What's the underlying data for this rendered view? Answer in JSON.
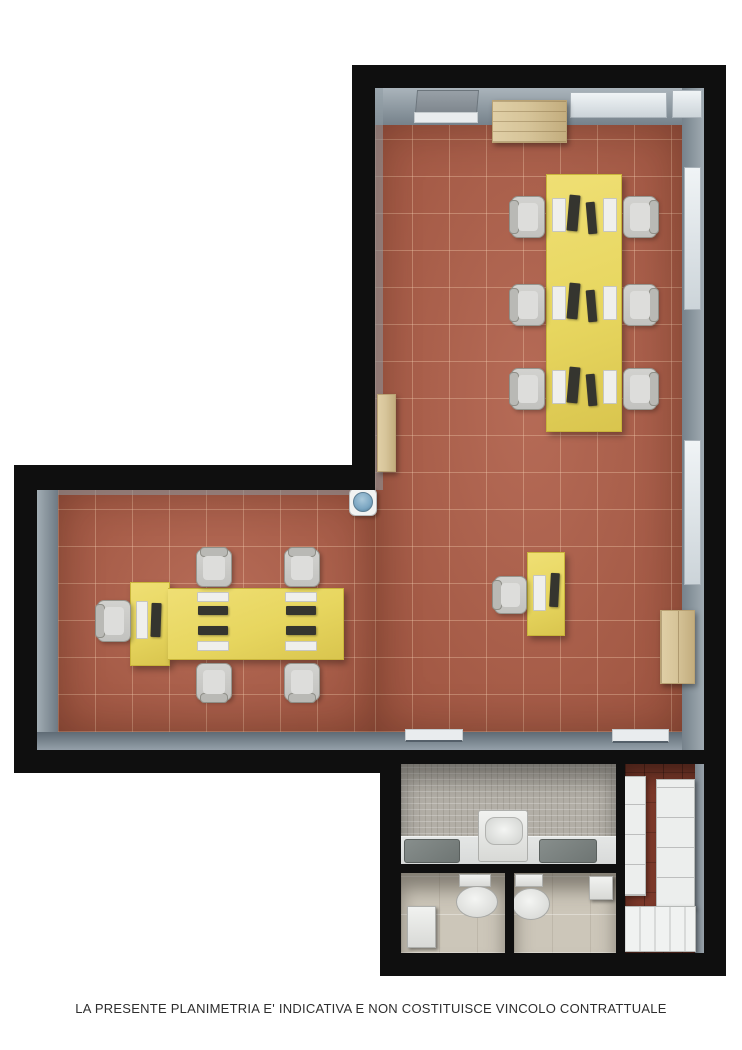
{
  "caption": "LA PRESENTE PLANIMETRIA E' INDICATIVA E NON COSTITUISCE VINCOLO CONTRATTUALE",
  "colors": {
    "floor_terracotta": "#b0604a",
    "floor_grout": "#d79a7f",
    "wall_black": "#0f0f0f",
    "wall_gray_light": "#9aa5ad",
    "wall_gray_dark": "#6f7b85",
    "desk_yellow": "#e7d65f",
    "desk_yellow_edge": "#c9b53b",
    "wood": "#d7c59a",
    "wood_dark": "#b9a274",
    "chair_fill": "#d2d2cf",
    "chair_back": "#b9b9b5",
    "monitor": "#35352f",
    "keyboard": "#efefec",
    "window_pane": "#e0e5e9",
    "door_panel": "#8d959c",
    "bath_wall": "#b2aea6",
    "bath_floor": "#ccc6b9",
    "bath_counter": "#d8dad9",
    "sink_dark": "#6e7573",
    "fixture_white": "#e9eae8",
    "storage_floor": "#7c392a",
    "unit_white": "#eceeed",
    "cooler_blue": "#7ba6c2",
    "caption_color": "#2e2e2e",
    "page_bg": "#ffffff"
  },
  "inventory": {
    "open_space_workstations": 6,
    "left_room_workstations": 5,
    "single_workstations": 1,
    "office_chairs": 12,
    "toilets": 2,
    "countertop_sinks": 2,
    "washbasin_units": 1,
    "radiator_units": 2,
    "wooden_cabinets": 2,
    "wooden_pallets": 1,
    "water_coolers": 1,
    "entrance_doors": 1,
    "windows": 3,
    "internal_door_leaves": 2
  }
}
